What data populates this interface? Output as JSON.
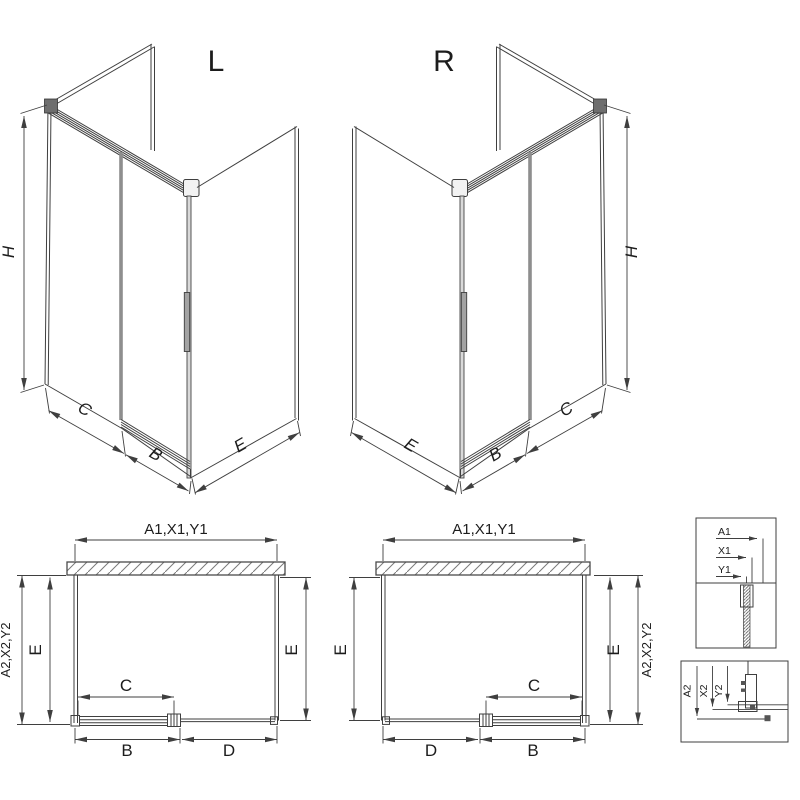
{
  "colors": {
    "line": "#3f3f3f",
    "door_edge_gray": "#8e8e8e",
    "text": "#1c1c1c",
    "background": "#ffffff"
  },
  "iso_left": {
    "variant_label": "L",
    "height_dim": "H",
    "fixed_panel_dim": "C",
    "door_dim": "B",
    "side_depth_dim": "E"
  },
  "iso_right": {
    "variant_label": "R",
    "height_dim": "H",
    "fixed_panel_dim": "C",
    "door_dim": "B",
    "side_depth_dim": "E"
  },
  "plan_left": {
    "width_dim": "A1,X1,Y1",
    "outer_depth_dim": "A2,X2,Y2",
    "left_depth_dim": "E",
    "right_depth_dim": "E",
    "opening_dim": "C",
    "door_dim": "B",
    "fixed_panel_dim": "D"
  },
  "plan_right": {
    "width_dim": "A1,X1,Y1",
    "outer_depth_dim": "A2,X2,Y2",
    "left_depth_dim": "E",
    "right_depth_dim": "E",
    "opening_dim": "C",
    "door_dim": "B",
    "fixed_panel_dim": "D"
  },
  "detail_width_profile": {
    "labels": [
      "A1",
      "X1",
      "Y1"
    ]
  },
  "detail_floor_profile": {
    "labels": [
      "A2",
      "X2",
      "Y2"
    ]
  }
}
